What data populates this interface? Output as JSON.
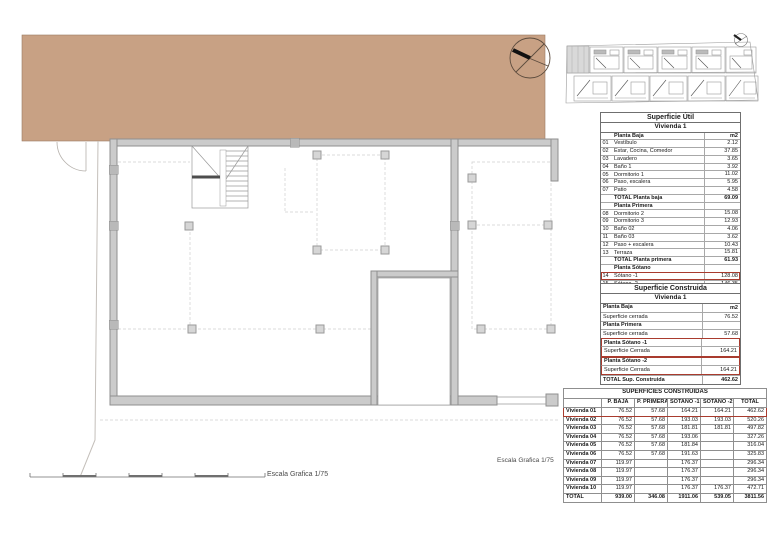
{
  "colors": {
    "roof_band": "#c8a184",
    "highlight_red": "#a93b2e",
    "wall_gray": "#cbcbcb"
  },
  "plan": {
    "scale_label_right": "Escala Grafica 1/75",
    "scale_label_bottom": "Escala Grafica 1/75"
  },
  "tables": {
    "util": {
      "title": "Superficie Útil",
      "subtitle": "Vivienda 1",
      "rows": [
        {
          "label": "Planta Baja",
          "value": "m2",
          "classes": [
            "sec"
          ]
        },
        {
          "num": "01",
          "label": "Vestíbulo",
          "value": "2.12",
          "classes": [
            "item"
          ]
        },
        {
          "num": "02",
          "label": "Estar, Cocina, Comedor",
          "value": "37.85",
          "classes": [
            "item"
          ]
        },
        {
          "num": "03",
          "label": "Lavadero",
          "value": "3.65",
          "classes": [
            "item"
          ]
        },
        {
          "num": "04",
          "label": "Baño 1",
          "value": "3.92",
          "classes": [
            "item"
          ]
        },
        {
          "num": "05",
          "label": "Dormitorio 1",
          "value": "11.02",
          "classes": [
            "item"
          ]
        },
        {
          "num": "06",
          "label": "Paso, escalera",
          "value": "5.95",
          "classes": [
            "item"
          ]
        },
        {
          "num": "07",
          "label": "Patio",
          "value": "4.58",
          "classes": [
            "item"
          ]
        },
        {
          "label": "TOTAL Planta baja",
          "value": "69.09",
          "classes": [
            "total"
          ]
        },
        {
          "label": "Planta Primera",
          "value": "",
          "classes": [
            "sec"
          ]
        },
        {
          "num": "08",
          "label": "Dormitorio 2",
          "value": "15.08",
          "classes": [
            "item"
          ]
        },
        {
          "num": "09",
          "label": "Dormitorio 3",
          "value": "12.93",
          "classes": [
            "item"
          ]
        },
        {
          "num": "10",
          "label": "Baño 02",
          "value": "4.06",
          "classes": [
            "item"
          ]
        },
        {
          "num": "11",
          "label": "Baño 03",
          "value": "3.62",
          "classes": [
            "item"
          ]
        },
        {
          "num": "12",
          "label": "Paso + escalera",
          "value": "10.43",
          "classes": [
            "item"
          ]
        },
        {
          "num": "13",
          "label": "Terraza",
          "value": "15.81",
          "classes": [
            "item"
          ]
        },
        {
          "label": "TOTAL Planta primera",
          "value": "61.93",
          "classes": [
            "total"
          ]
        },
        {
          "label": "Planta Sótano",
          "value": "",
          "classes": [
            "sec"
          ]
        },
        {
          "num": "14",
          "label": "Sótano -1",
          "value": "128.08",
          "classes": [
            "item",
            "hl-box"
          ]
        },
        {
          "num": "15",
          "label": "Sótano -2",
          "value": "146.35",
          "classes": [
            "item"
          ]
        },
        {
          "label": "TOTAL",
          "value": "405.45",
          "classes": [
            "total"
          ]
        }
      ]
    },
    "construida": {
      "title": "Superficie Construida",
      "subtitle": "Vivienda 1",
      "rows": [
        {
          "label": "Planta Baja",
          "value": "m2",
          "classes": [
            "sec"
          ]
        },
        {
          "label": "Superficie cerrada",
          "value": "76.52",
          "classes": [
            "item"
          ]
        },
        {
          "label": "Planta Primera",
          "value": "",
          "classes": [
            "sec"
          ]
        },
        {
          "label": "Superficie cerrada",
          "value": "57.68",
          "classes": [
            "item"
          ]
        },
        {
          "label": "Planta Sótano -1",
          "value": "",
          "classes": [
            "sec",
            "hl-side",
            "hl-top"
          ]
        },
        {
          "label": "Superficie Cerrada",
          "value": "164.21",
          "classes": [
            "item",
            "hl-side",
            "hl-bottom"
          ]
        },
        {
          "label": "Planta Sótano -2",
          "value": "",
          "classes": [
            "sec",
            "hl-side",
            "hl-top"
          ]
        },
        {
          "label": "Superficie Cerrada",
          "value": "164.21",
          "classes": [
            "item",
            "hl-side",
            "hl-bottom"
          ]
        },
        {
          "label": "TOTAL Sup. Construida",
          "value": "462.62",
          "classes": [
            "total"
          ]
        }
      ]
    },
    "summary": {
      "title": "SUPERFICIES CONSTRUIDAS",
      "headers": [
        "",
        "P. BAJA",
        "P. PRIMERA",
        "SÓTANO -1",
        "SÓTANO -2",
        "TOTAL"
      ],
      "rows": [
        {
          "name": "Vivienda 01",
          "cells": [
            "76.52",
            "57.68",
            "164.21",
            "164.21",
            "462.62"
          ],
          "classes": [
            "hl-row"
          ]
        },
        {
          "name": "Vivienda 02",
          "cells": [
            "76.52",
            "57.68",
            "193.03",
            "193.03",
            "520.26"
          ],
          "classes": []
        },
        {
          "name": "Vivienda 03",
          "cells": [
            "76.52",
            "57.68",
            "181.81",
            "181.81",
            "497.82"
          ],
          "classes": []
        },
        {
          "name": "Vivienda 04",
          "cells": [
            "76.52",
            "57.68",
            "193.06",
            "",
            "327.26"
          ],
          "classes": []
        },
        {
          "name": "Vivienda 05",
          "cells": [
            "76.52",
            "57.68",
            "181.84",
            "",
            "316.04"
          ],
          "classes": []
        },
        {
          "name": "Vivienda 06",
          "cells": [
            "76.52",
            "57.68",
            "191.63",
            "",
            "325.83"
          ],
          "classes": []
        },
        {
          "name": "Vivienda 07",
          "cells": [
            "119.97",
            "",
            "176.37",
            "",
            "296.34"
          ],
          "classes": []
        },
        {
          "name": "Vivienda 08",
          "cells": [
            "119.97",
            "",
            "176.37",
            "",
            "296.34"
          ],
          "classes": []
        },
        {
          "name": "Vivienda 09",
          "cells": [
            "119.97",
            "",
            "176.37",
            "",
            "296.34"
          ],
          "classes": []
        },
        {
          "name": "Vivienda 10",
          "cells": [
            "119.97",
            "",
            "176.37",
            "176.37",
            "472.71"
          ],
          "classes": []
        },
        {
          "name": "TOTAL",
          "cells": [
            "939.00",
            "346.08",
            "1911.06",
            "539.05",
            "3811.56"
          ],
          "classes": [
            "total-row"
          ]
        }
      ]
    }
  }
}
